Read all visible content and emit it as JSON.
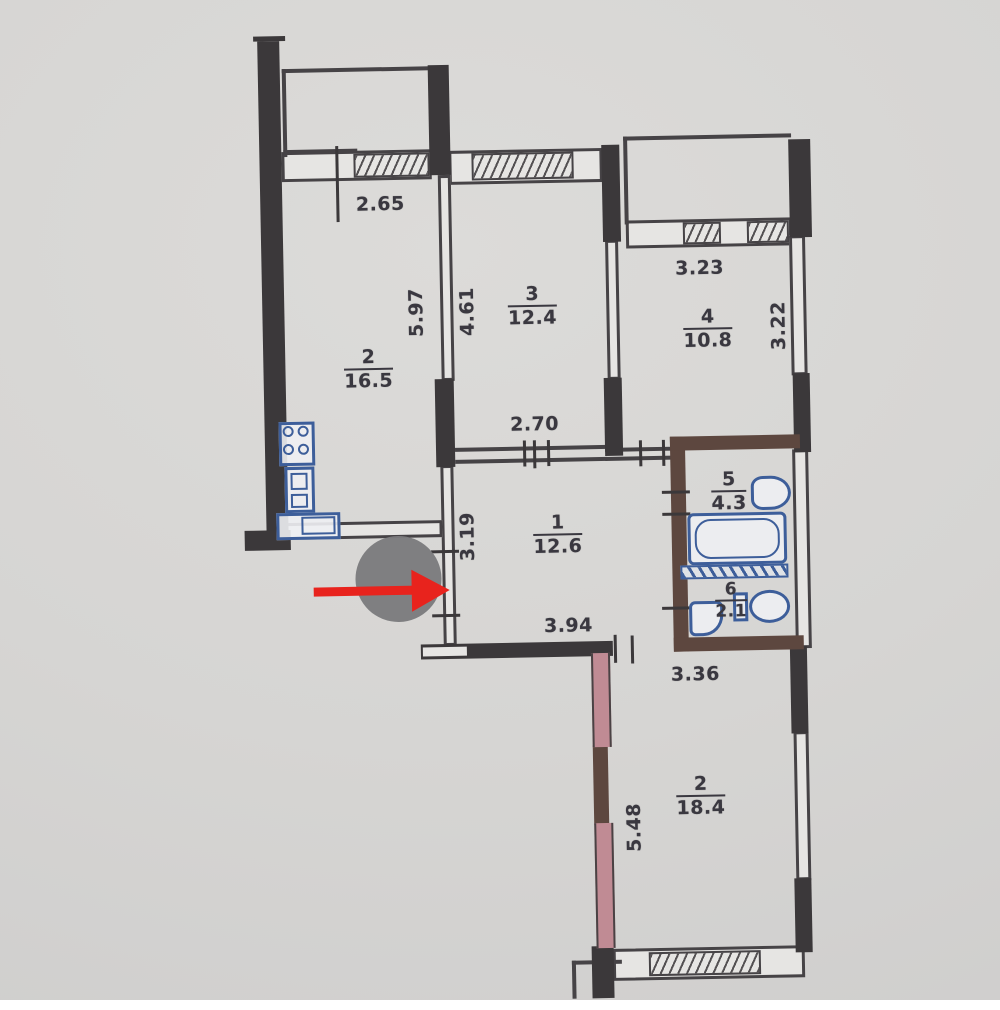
{
  "plan": {
    "title": "apartment-floor-plan",
    "rooms": [
      {
        "key": "kitchen",
        "number": "2",
        "area": "16.5"
      },
      {
        "key": "room-3",
        "number": "3",
        "area": "12.4"
      },
      {
        "key": "room-4",
        "number": "4",
        "area": "10.8"
      },
      {
        "key": "bathroom",
        "number": "5",
        "area": "4.3"
      },
      {
        "key": "hallway",
        "number": "1",
        "area": "12.6"
      },
      {
        "key": "wc",
        "number": "6",
        "area": "2.1"
      },
      {
        "key": "bedroom",
        "number": "2",
        "area": "18.4"
      }
    ],
    "dimensions": [
      {
        "value": "2.65",
        "orientation": "h"
      },
      {
        "value": "5.97",
        "orientation": "v"
      },
      {
        "value": "4.61",
        "orientation": "v"
      },
      {
        "value": "2.70",
        "orientation": "h"
      },
      {
        "value": "3.23",
        "orientation": "h"
      },
      {
        "value": "3.22",
        "orientation": "v"
      },
      {
        "value": "3.19",
        "orientation": "v"
      },
      {
        "value": "3.94",
        "orientation": "h"
      },
      {
        "value": "3.36",
        "orientation": "h"
      },
      {
        "value": "5.48",
        "orientation": "v"
      }
    ],
    "annotations": {
      "pointer": {
        "shape": "arrow",
        "direction": "right",
        "color": "#e8231d"
      },
      "marker": {
        "shape": "circle",
        "color": "#7b7b7d"
      }
    },
    "colors": {
      "wall": "#3b383a",
      "bath_wall": "#5d473f",
      "pink_wall": "#c08b94",
      "fixtures": "#3d5e9a",
      "paper": "#d6d5d3"
    }
  }
}
